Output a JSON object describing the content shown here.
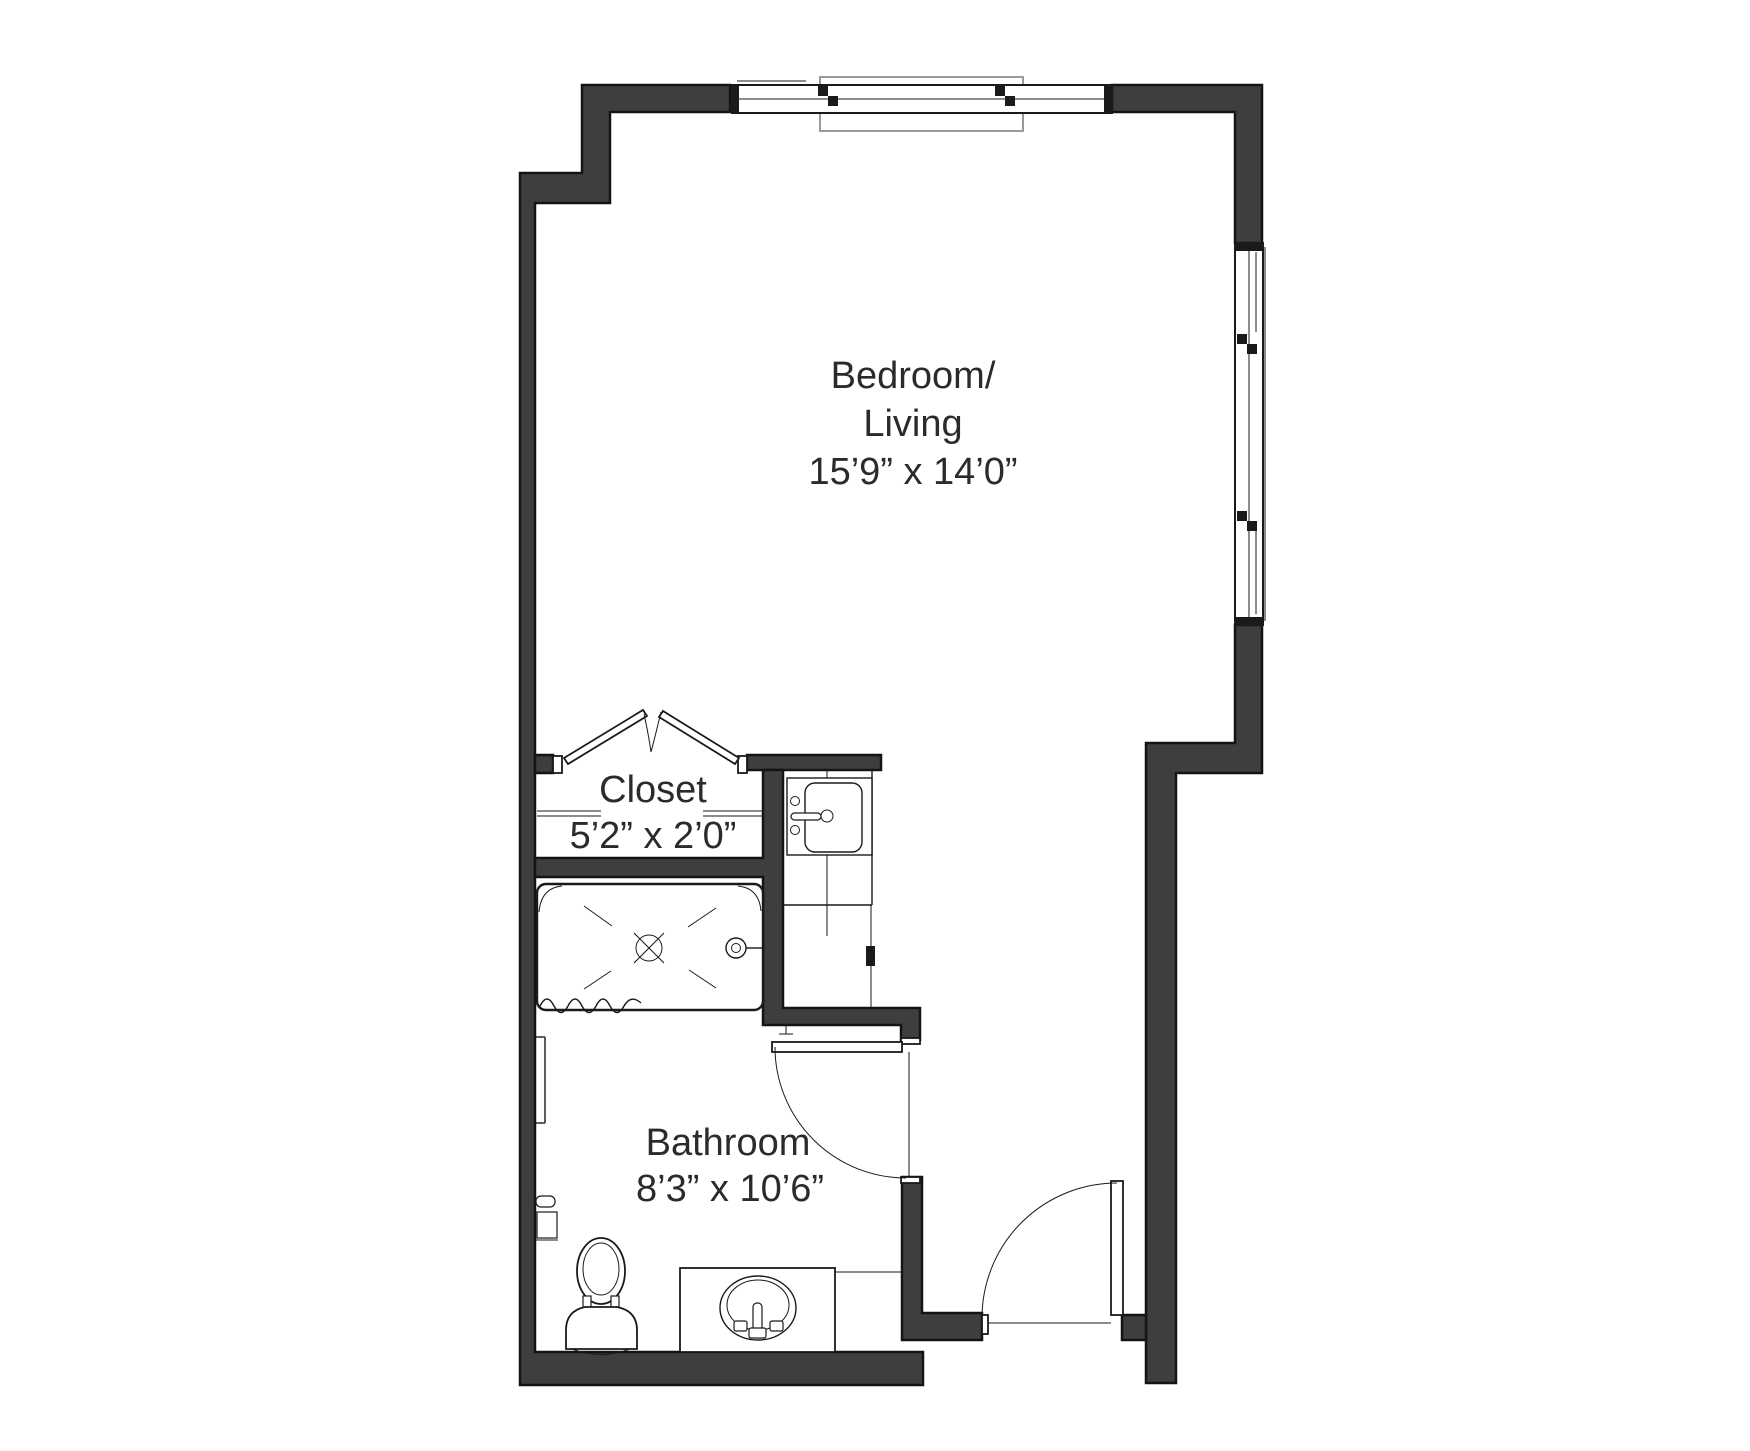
{
  "document_title": "Studio Apartment Floor Plan",
  "colors": {
    "wall_fill": "#3e3e3e",
    "wall_stroke": "#141414",
    "line_color": "#1a1a1a",
    "text_color": "#2b2b2b",
    "casing_color": "#9a9a9a",
    "background": "#ffffff"
  },
  "rooms": {
    "bedroom_living": {
      "label_line1": "Bedroom/",
      "label_line2": "Living",
      "dimensions": "15’9” x 14’0”"
    },
    "closet": {
      "label": "Closet",
      "dimensions": "5’2” x 2’0”"
    },
    "bathroom": {
      "label": "Bathroom",
      "dimensions": "8’3” x 10’6”"
    }
  }
}
